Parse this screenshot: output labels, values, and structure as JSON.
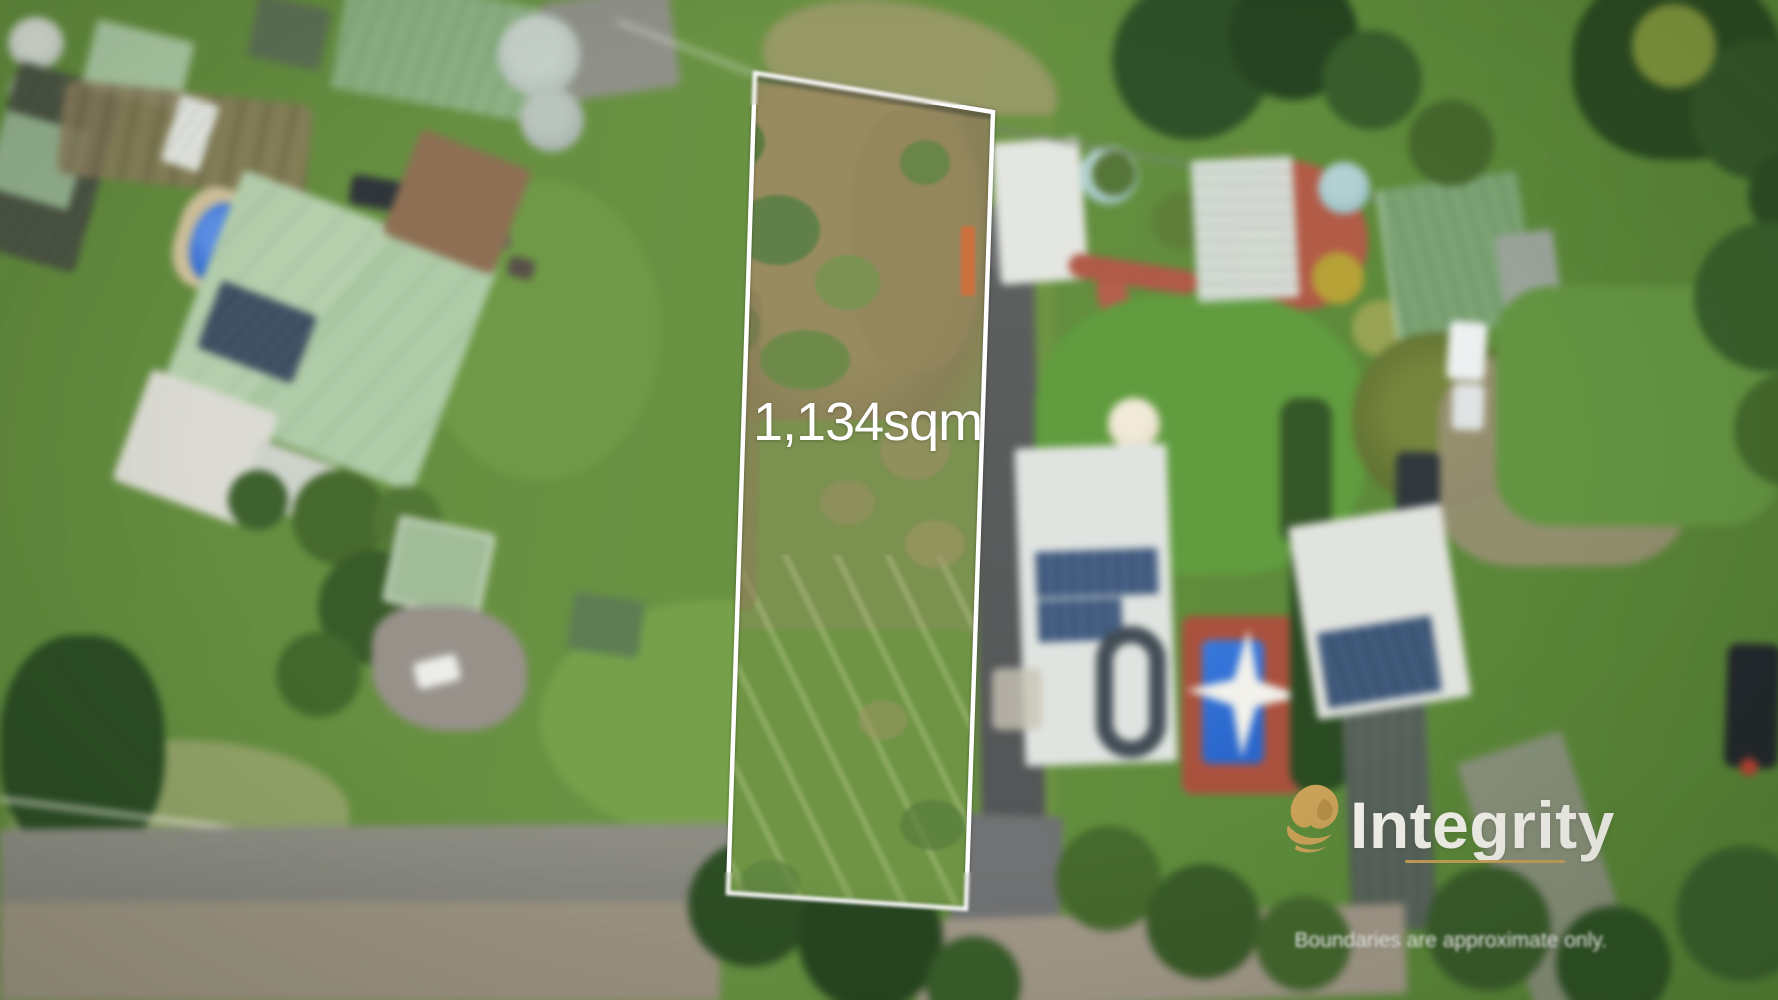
{
  "photo": {
    "kind": "aerial-drone-photograph",
    "lot": {
      "area_label": "1,134sqm",
      "boundary_points": "755,73 993,112 966,909 728,893",
      "boundary_color": "#ffffff",
      "label_color": "#ffffff"
    }
  },
  "branding": {
    "agency_name": "Integrity",
    "lion_gold": "#c9a158",
    "wordmark_color": "#f5f3ee",
    "underline_color": "#c9a158"
  },
  "disclaimer": "Boundaries are approximate only."
}
